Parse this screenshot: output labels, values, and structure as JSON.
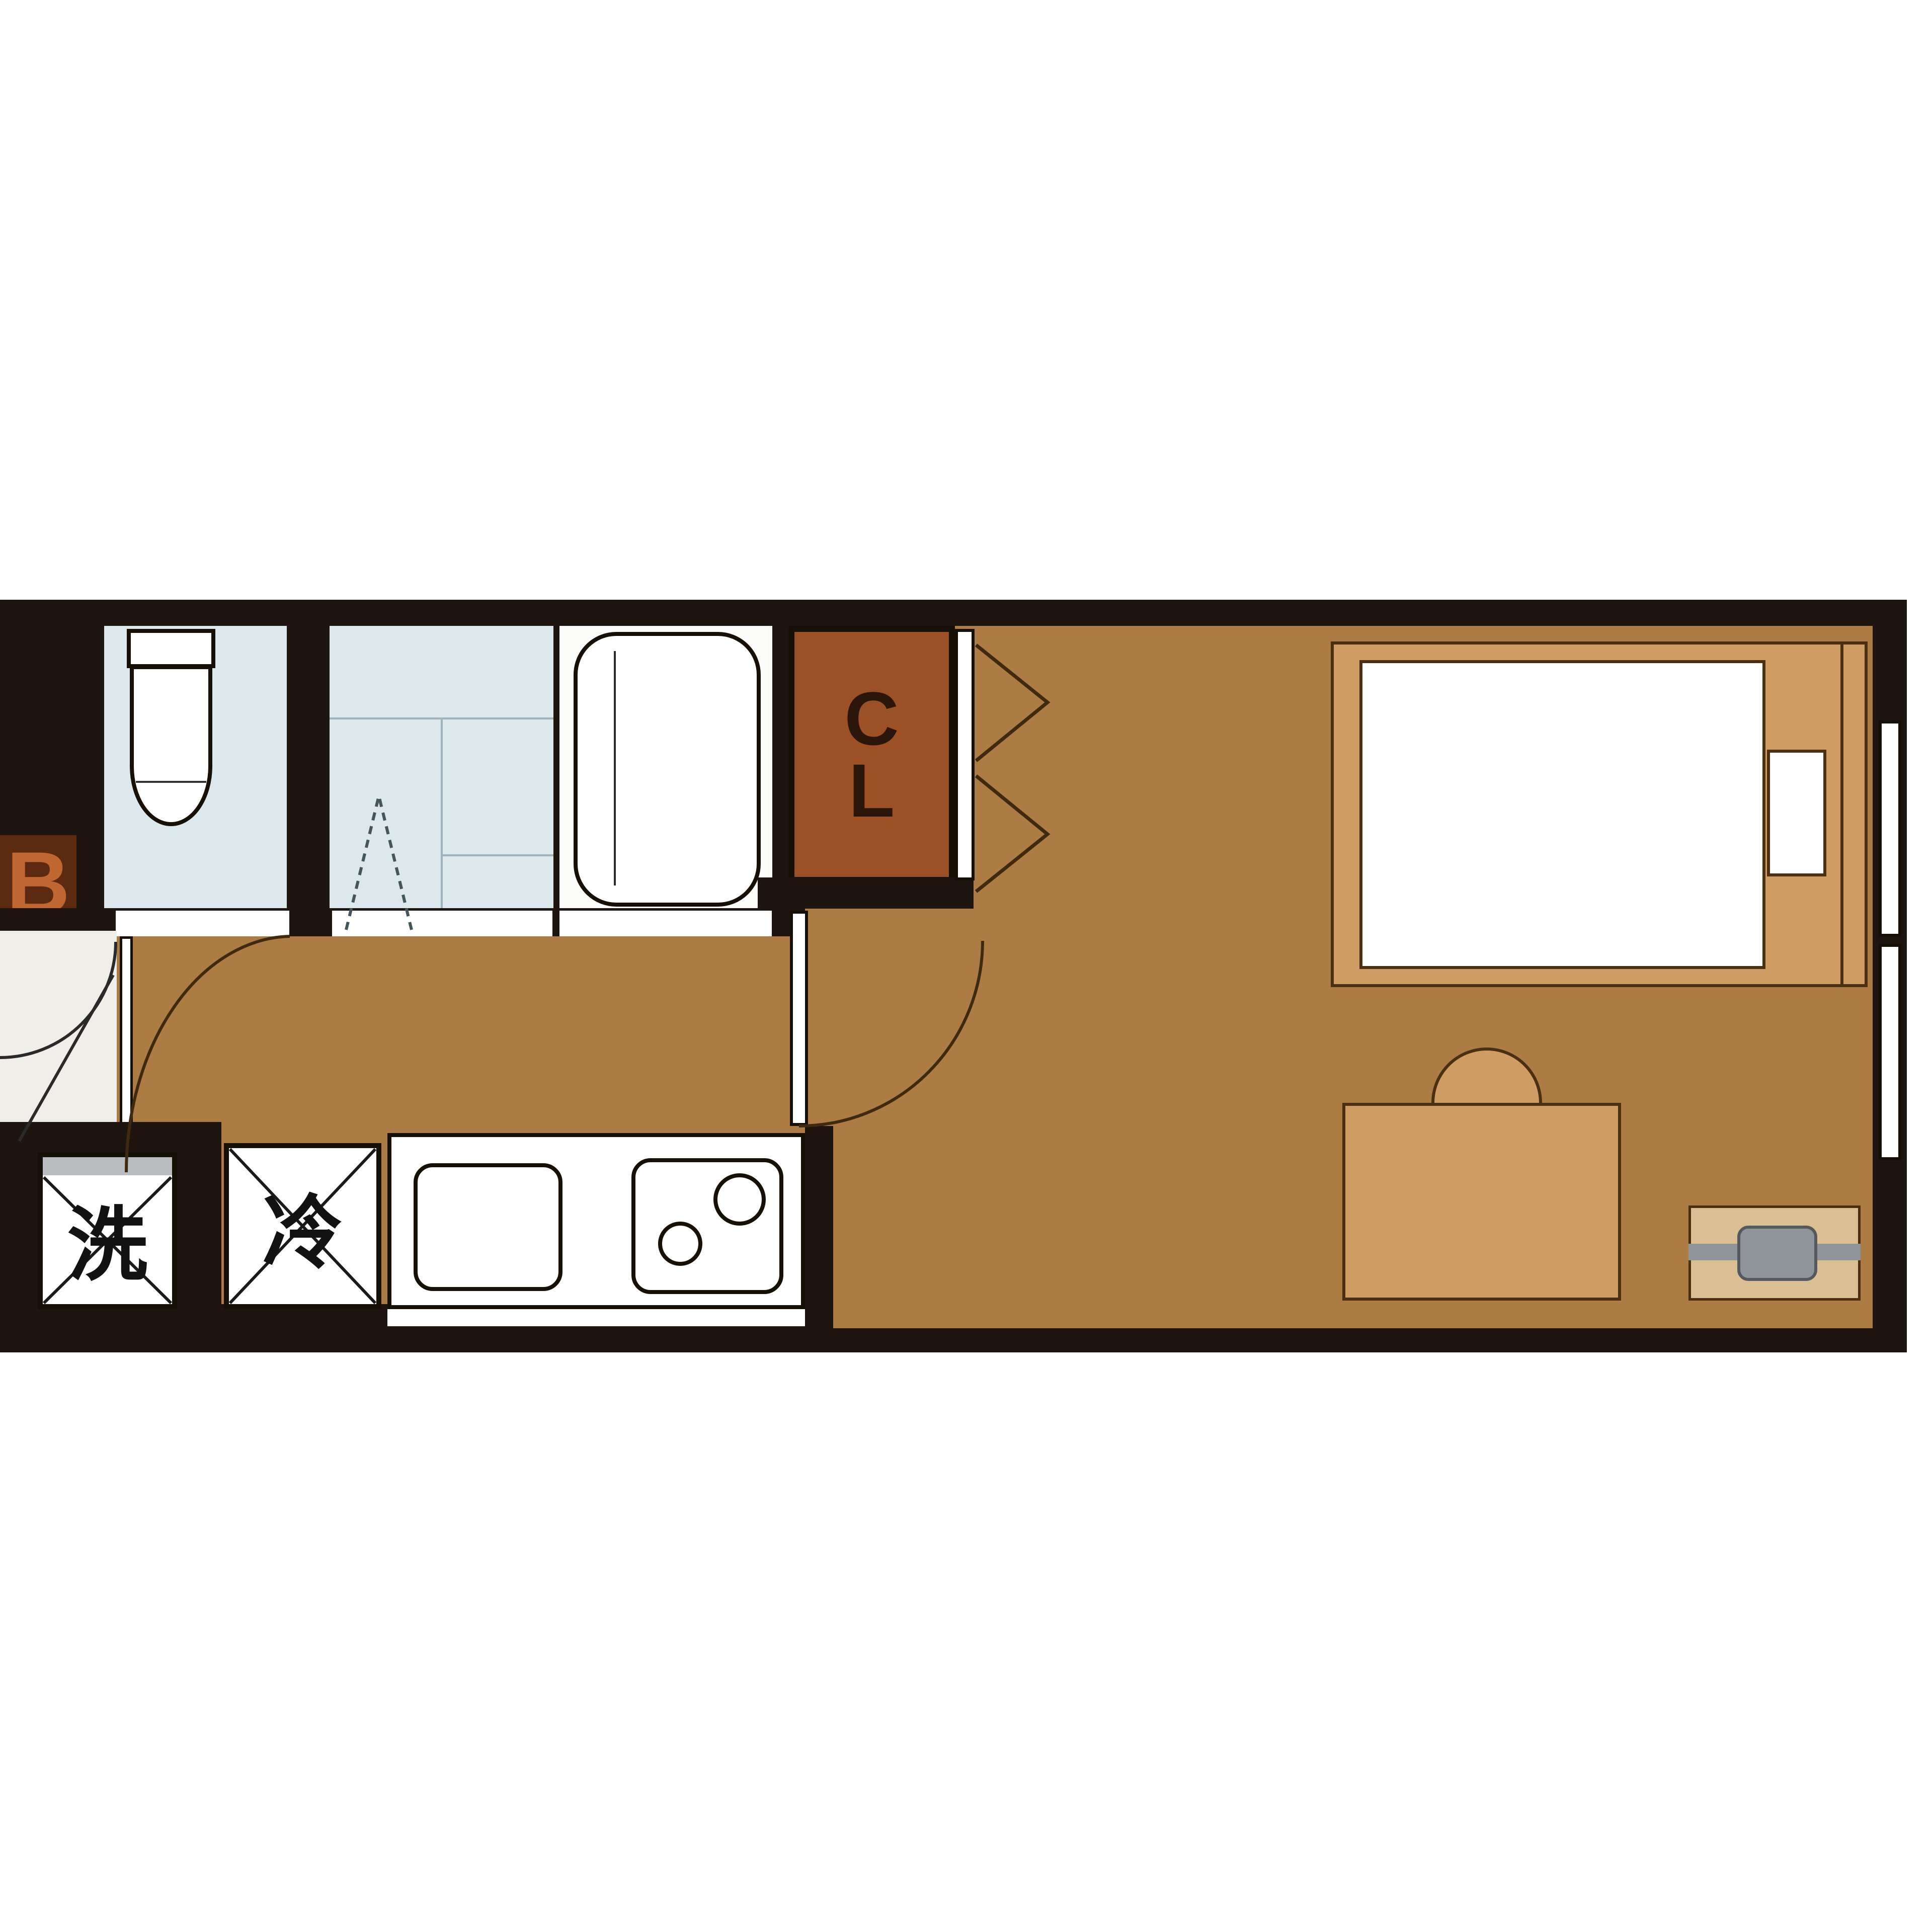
{
  "labels": {
    "bath_label": "B",
    "closet_c": "C",
    "closet_l": "L",
    "washer": "洗",
    "fridge": "冷"
  },
  "colors": {
    "wall": "#1e1510",
    "floor": "#ad7c44",
    "wet_room": "#dce8ec",
    "wet_lines": "#9fb4bc",
    "bath_floor": "#fbfbfa",
    "closet_bg": "#9c5026",
    "closet_text": "#2a160b",
    "bath_label_bg": "#5c2a10",
    "bath_label_text": "#c06630",
    "furniture": "#cf9d63",
    "furniture_outline": "#4a2f12",
    "tv_stand": "#dabf94",
    "accent_gray": "#8e9499",
    "genkan": "#f0eee9",
    "door_arc": "#3f2a10"
  }
}
